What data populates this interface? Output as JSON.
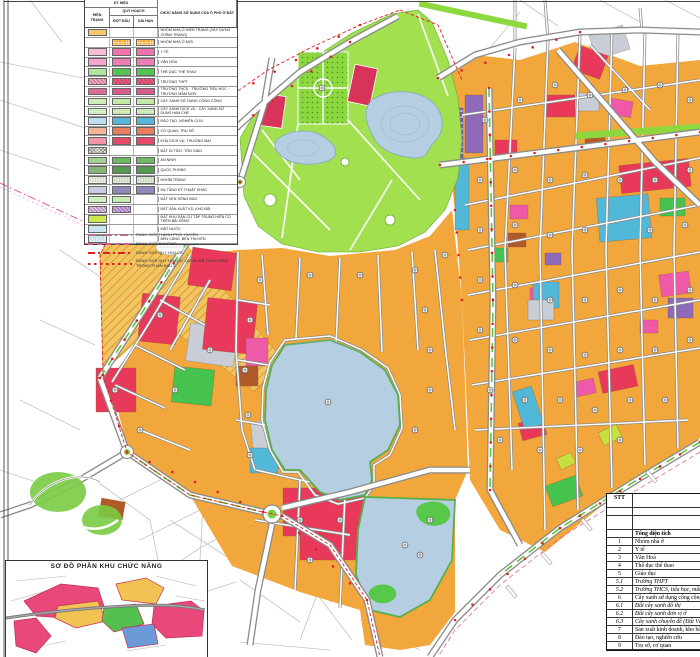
{
  "legend": {
    "title_ky_hieu": "KÝ HIỆU",
    "col_hien_trang": "HIỆN TRẠNG",
    "col_quy_hoach": "QUY HOẠCH",
    "col_dot_dau": "ĐỢT ĐẦU",
    "col_dai_han": "DÀI HẠN",
    "col_chuc_nang": "CHỨC NĂNG SỬ DỤNG CỦA Ô PHỐ Ở ĐẤT",
    "rows": [
      {
        "label": "NHÓM NHÀ Ở HIỆN TRẠNG (XÂY DỰNG CHỈNH TRANG)",
        "ht": "#F4C96A",
        "dd": null,
        "dh": null
      },
      {
        "label": "NHÓM NHÀ Ở MỚI",
        "ht": null,
        "dd": "#F5A832",
        "dh": "#F5A832",
        "pat": "grid"
      },
      {
        "label": "Y TẾ",
        "ht": "#F8BCD6",
        "dd": "#F272AE",
        "dh": "#F272AE"
      },
      {
        "label": "VĂN HÓA",
        "ht": "#F4A6CC",
        "dd": "#EE7EB8",
        "dh": "#EE7EB8"
      },
      {
        "label": "THỂ DỤC THỂ THAO",
        "ht": "#B2E4A0",
        "dd": "#55C34F",
        "dh": "#55C34F"
      },
      {
        "label": "TRƯỜNG THPT",
        "ht": "#F2A8B8",
        "dd": "#E85A78",
        "dh": "#E85A78",
        "pat": "hatch"
      },
      {
        "label": "TRƯỜNG THCS · TRƯỜNG TIỂU HỌC · TRƯỜNG MẦM NON",
        "ht": "#DB6E98",
        "dd": "#D65C8C",
        "dh": "#D65C8C"
      },
      {
        "label": "CÂY XANH SỬ DỤNG CÔNG CỘNG",
        "ht": "#CFEDB9",
        "dd": "#C2E9A8",
        "dh": "#C2E9A8"
      },
      {
        "label": "CÂY XANH DỊCH VỤ · CÂY XANH SỬ DỤNG HẠN CHẾ",
        "ht": "#DDF3C9",
        "dd": "#D5F0BE",
        "dh": "#D5F0BE",
        "pat": "dots"
      },
      {
        "label": "ĐÀO TẠO, NGHIÊN CỨU",
        "ht": "#BBDFF0",
        "dd": "#57B7D9",
        "dh": "#57B7D9"
      },
      {
        "label": "CƠ QUAN, TRỤ SỞ",
        "ht": "#F4B59C",
        "dd": "#EA7E5C",
        "dh": "#EA7E5C"
      },
      {
        "label": "KHU DỊCH VỤ, THƯƠNG MẠI",
        "ht": "#F295A4",
        "dd": "#E84A6C",
        "dh": "#E84A6C"
      },
      {
        "label": "ĐẤT DI TÍCH, TÔN GIÁO",
        "ht": "#E8E3DA",
        "dd": null,
        "dh": null,
        "pat": "cross"
      },
      {
        "label": "AN NINH",
        "ht": "#A5CF97",
        "dd": "#6FB863",
        "dh": "#6FB863"
      },
      {
        "label": "QUỐC PHÒNG",
        "ht": "#86B478",
        "dd": "#579B53",
        "dh": "#579B53"
      },
      {
        "label": "NGHĨA TRANG",
        "ht": "#E7ECDF",
        "dd": "#DCE6D2",
        "dh": "#DCE6D2",
        "pat": "dots"
      },
      {
        "label": "HẠ TẦNG KỸ THUẬT KHÁC",
        "ht": "#C8CCE6",
        "dd": "#9188BB",
        "dh": "#9188BB"
      },
      {
        "label": "ĐẤT VEN SÔNG ĐÀO",
        "ht": "#D2F0C2",
        "dd": "#C6ECB2",
        "dh": null
      },
      {
        "label": "ĐẤT SẢN XUẤT KD, KHO BÃI",
        "ht": "#D9C2E6",
        "dd": "#C9A6DD",
        "dh": null,
        "pat": "hatch"
      },
      {
        "label": "ĐẤT KHU DÂN CƯ TẬP TRUNG HIỆN CÓ TRÊN BÃI SÔNG",
        "ht": "#CDE94E",
        "dd": null,
        "dh": null
      },
      {
        "label": "MẶT NƯỚC",
        "ht": "#CBE4F2",
        "dd": null,
        "dh": null
      },
      {
        "label": "BẾN CẢNG, BẾN THUYỀN",
        "ht": "#D9EDF5",
        "dd": null,
        "dh": null,
        "pat": "dots"
      }
    ],
    "lines": [
      {
        "label": "RANH GIỚI THÀNH PHỐ, HUYỆN",
        "style": "dashdot-grey"
      },
      {
        "label": "RANH GIỚI PHƯỜNG",
        "style": "dash-pink"
      },
      {
        "label": "RANH GIỚI QUY HOẠCH",
        "style": "dashdot-red"
      },
      {
        "label": "RANH GIỚI QUY HOẠCH, DỰ ÁN ĐÃ THỰC HIỆN TRONG PHÂN KHU 2",
        "style": "dots-red"
      }
    ]
  },
  "inset": {
    "title": "SƠ ĐỒ PHÂN KHU CHỨC NĂNG"
  },
  "table": {
    "col_stt": "STT",
    "col_ten": "Tên phường",
    "row_dan_so": "Dân số (người)",
    "row_chuc_nang": "Chức năng sử dụng ô phố",
    "rows": [
      {
        "stt": "",
        "label": "Tổng diện tích",
        "bold": true
      },
      {
        "stt": "1",
        "label": "Nhóm nhà ở"
      },
      {
        "stt": "2",
        "label": "Y tế"
      },
      {
        "stt": "3",
        "label": "Văn Hoá"
      },
      {
        "stt": "4",
        "label": "Thể dục thể thao"
      },
      {
        "stt": "5",
        "label": "Giáo dục"
      },
      {
        "stt": "5.1",
        "label": "Trường THPT",
        "italic": true
      },
      {
        "stt": "5.2",
        "label": "Trường THCS, tiểu học, mầm non",
        "italic": true
      },
      {
        "stt": "6",
        "label": "Cây xanh sử dụng công cộng"
      },
      {
        "stt": "6.1",
        "label": "Đất cây xanh đô thị",
        "italic": true
      },
      {
        "stt": "6.2",
        "label": "Đất cây xanh đơn vị ở",
        "italic": true
      },
      {
        "stt": "6.3",
        "label": "Cây xanh chuyên đề (Đất Văn hóa)",
        "italic": true
      },
      {
        "stt": "7",
        "label": "Sản xuất kinh doanh, kho bãi"
      },
      {
        "stt": "8",
        "label": "Đào tạo, nghiên cứu"
      },
      {
        "stt": "9",
        "label": "Trụ sở, cơ quan"
      }
    ]
  },
  "map": {
    "colors": {
      "residential_orange": "#F2A73C",
      "commercial_red": "#E8395A",
      "park_green": "#A2E050",
      "lake_blue": "#B5CEE2",
      "education_cyan": "#52B8D8",
      "infra_purple": "#8E6AB8",
      "office_brown": "#B05A2A",
      "boundary_red": "#E02020",
      "city_boundary_pink": "#E06A9A",
      "road_casing": "#8A8A8A",
      "median_green": "#62C23E"
    }
  }
}
